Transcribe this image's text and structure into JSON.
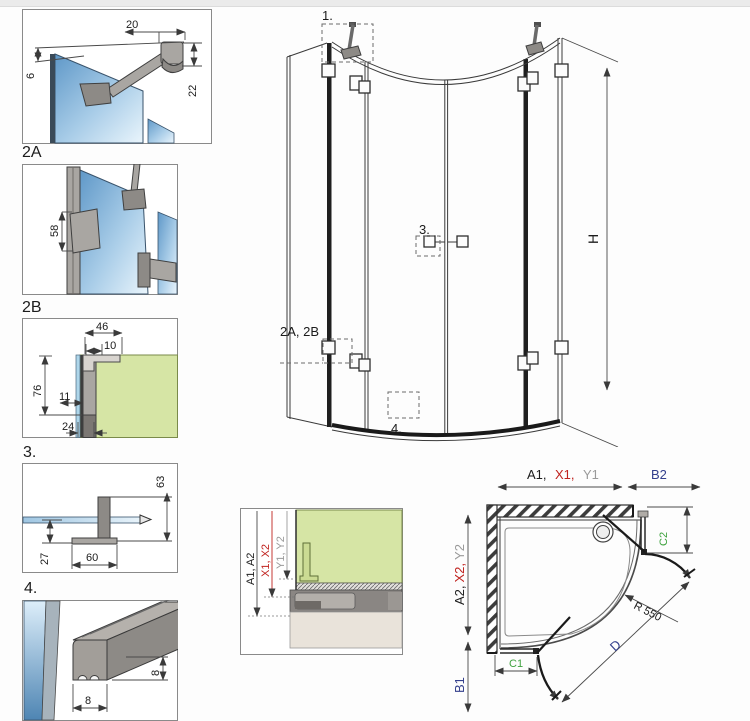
{
  "d1": {
    "dim_20": "20",
    "dim_6": "6",
    "dim_22": "22"
  },
  "d2a": {
    "label": "2A",
    "dim_58": "58"
  },
  "d2b": {
    "label": "2B",
    "dim_46": "46",
    "dim_10": "10",
    "dim_76": "76",
    "dim_11": "11",
    "dim_24": "24"
  },
  "d3": {
    "label": "3.",
    "dim_63": "63",
    "dim_27": "27",
    "dim_60": "60"
  },
  "d4": {
    "label": "4.",
    "dim_8_height": "8",
    "dim_8_width": "8"
  },
  "main": {
    "callout_1": "1.",
    "callout_3": "3.",
    "callout_2ab": "2A, 2B",
    "callout_4": "4.",
    "dim_h": "H"
  },
  "section": {
    "dim_a": "A1, A2",
    "dim_x": "X1, X2",
    "dim_y": "Y1, Y2"
  },
  "plan": {
    "dim_a1": "A1,",
    "dim_x1": "X1,",
    "dim_y1": "Y1",
    "dim_b2": "B2",
    "dim_a2": "A2,",
    "dim_x2": "X2,",
    "dim_y2": "Y2",
    "dim_b1": "B1",
    "dim_c1": "C1",
    "dim_c2": "C2",
    "dim_radius": "R 550",
    "dim_d": "D"
  },
  "colors": {
    "glass_dark": "#6ba3d2",
    "glass_light": "#e9f4fb",
    "wall_green": "#d6e5a5",
    "metal": "#a9a6a2",
    "line": "#3a3a3a",
    "dim_red": "#c0231f",
    "dim_gray": "#9a9a9a",
    "dim_navy": "#333f8c",
    "dim_green": "#3fa23f",
    "seal_beige": "#e9e3da"
  }
}
